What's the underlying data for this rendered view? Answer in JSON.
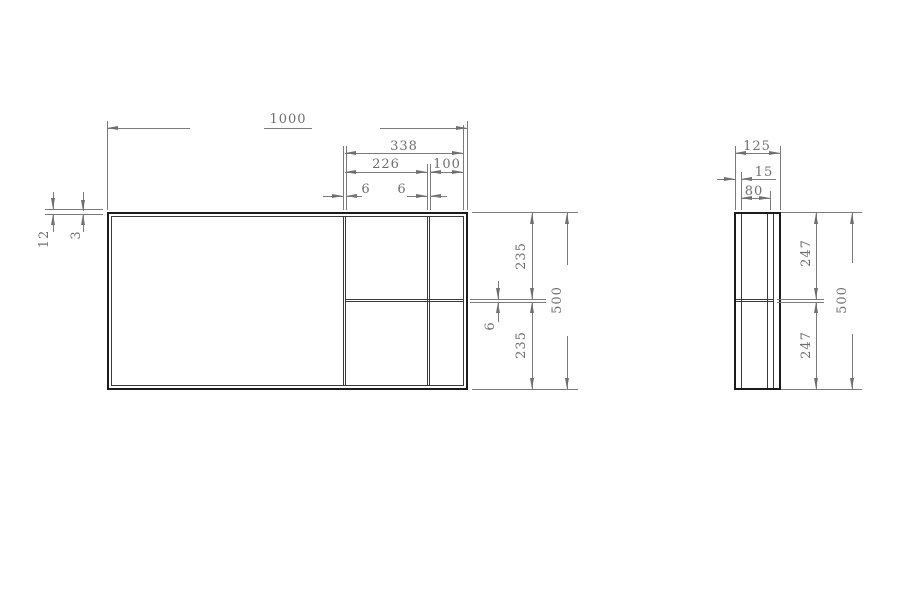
{
  "drawing": {
    "type": "technical-dimension-drawing",
    "colors": {
      "outline": "#1c1c1c",
      "structure": "#3a3a3a",
      "dimension": "#7b7b7b",
      "text": "#6f6f6f",
      "background": "#ffffff"
    },
    "dims": {
      "front": {
        "total_width": "1000",
        "right_section_width": "338",
        "right_section_opening": "226",
        "end_column_width": "100",
        "divider_a_thickness": "6",
        "divider_b_thickness": "6",
        "frame_edge": "12",
        "frame_face": "3",
        "upper_opening_height": "235",
        "shelf_thickness": "6",
        "lower_opening_height": "235",
        "total_height": "500"
      },
      "side": {
        "total_depth": "125",
        "front_panel_depth": "15",
        "body_depth": "80",
        "upper_opening_height": "247",
        "lower_opening_height": "247",
        "total_height": "500"
      }
    }
  }
}
